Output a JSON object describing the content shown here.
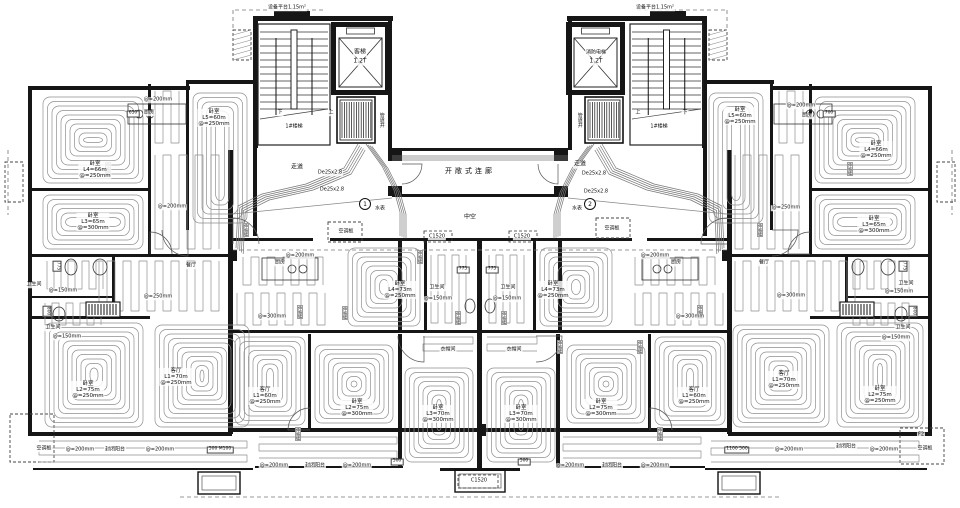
{
  "cores": {
    "left": {
      "platform_area": "设备平台1.15m²",
      "stair": "1#楼梯",
      "up": "上",
      "down": "下",
      "elevator": "客梯",
      "elevator_capacity": "1.2T",
      "shaft": "管道井",
      "corridor": "走道",
      "pipe_spec_1": "De25x2.8",
      "pipe_spec_2": "De25x2.8",
      "water_meter": "水表",
      "meter_no": "1",
      "ac_panel": "空调板"
    },
    "right": {
      "platform_area": "设备平台1.15m²",
      "stair": "1#楼梯",
      "up": "上",
      "down": "下",
      "elevator": "消防电梯",
      "elevator_capacity": "1.2T",
      "shaft": "管道井",
      "corridor": "走道",
      "pipe_spec_1": "De25x2.8",
      "pipe_spec_2": "De25x2.8",
      "water_meter": "水表",
      "meter_no": "2",
      "ac_panel": "空调板"
    }
  },
  "bridge": {
    "connector": "开敞式连廊",
    "void_space": "中空",
    "window_tag": "C1520"
  },
  "rooms": [
    {
      "name": "卧室",
      "circuit": "L4=66m",
      "spacing": "@=250mm"
    },
    {
      "name": "卧室",
      "circuit": "L3=65m",
      "spacing": "@=300mm"
    },
    {
      "name": "卧室",
      "circuit": "L5=60m",
      "spacing": "@=250mm"
    },
    {
      "name": "卧室",
      "circuit": "L2=75m",
      "spacing": "@=250mm"
    },
    {
      "name": "客厅",
      "circuit": "L1=70m",
      "spacing": "@=250mm"
    },
    {
      "name": "客厅",
      "circuit": "L1=60m",
      "spacing": "@=250mm"
    },
    {
      "name": "卧室",
      "circuit": "L4=73m",
      "spacing": "@=250mm"
    },
    {
      "name": "卧室",
      "circuit": "L2=75m",
      "spacing": "@=300mm"
    },
    {
      "name": "卧室",
      "circuit": "L3=70m",
      "spacing": "@=300mm"
    },
    {
      "name": "卧室",
      "circuit": "L4=73m",
      "spacing": "@=250mm"
    },
    {
      "name": "卧室",
      "circuit": "L2=75m",
      "spacing": "@=300mm"
    },
    {
      "name": "卧室",
      "circuit": "L3=70m",
      "spacing": "@=300mm"
    },
    {
      "name": "客厅",
      "circuit": "L1=60m",
      "spacing": "@=250mm"
    },
    {
      "name": "卧室",
      "circuit": "L5=60m",
      "spacing": "@=250mm"
    },
    {
      "name": "卧室",
      "circuit": "L4=66m",
      "spacing": "@=250mm"
    },
    {
      "name": "卧室",
      "circuit": "L3=65m",
      "spacing": "@=300mm"
    },
    {
      "name": "客厅",
      "circuit": "L1=70m",
      "spacing": "@=250mm"
    },
    {
      "name": "卧室",
      "circuit": "L2=75m",
      "spacing": "@=250mm"
    }
  ],
  "zones": [
    {
      "name": "厨房",
      "spacing": "@=200mm",
      "dim": "650"
    },
    {
      "spacing": "@=200mm"
    },
    {
      "name": "餐厅",
      "spacing": "@=250mm"
    },
    {
      "name": "厨房",
      "spacing": "@=200mm"
    },
    {
      "spacing": "@=300mm"
    },
    {
      "name": "厨房",
      "spacing": "@=200mm"
    },
    {
      "spacing": "@=300mm"
    },
    {
      "spacing": "@=250mm"
    },
    {
      "name": "餐厅",
      "spacing": "@=300mm"
    },
    {
      "name": "厨房",
      "spacing": "@=200mm",
      "dim": "700"
    }
  ],
  "baths": [
    {
      "name": "卫生间",
      "spacing": "@=150mm",
      "dim": "775"
    },
    {
      "name": "卫生间",
      "spacing": "@=150mm",
      "dim": "800"
    },
    {
      "name": "卫生间",
      "spacing": "@=150mm",
      "dim": "775"
    },
    {
      "name": "卫生间",
      "spacing": "@=150mm",
      "dim": "775"
    },
    {
      "name": "卫生间",
      "spacing": "@=150mm",
      "dim": "775"
    },
    {
      "name": "卫生间",
      "spacing": "@=150mm",
      "dim": "800"
    }
  ],
  "closets": [
    {
      "name": "衣帽间"
    },
    {
      "name": "衣帽间"
    }
  ],
  "balconies": [
    {
      "spacing_left": "@=200mm",
      "name": "封闭阳台",
      "spacing_right": "@=200mm",
      "dim": "500 M100",
      "ac_panel": "空调板"
    },
    {
      "spacing_left": "@=200mm",
      "name": "封闭阳台",
      "spacing_right": "@=200mm",
      "dim": "500"
    },
    {
      "spacing_left": "@=200mm",
      "name": "封闭阳台",
      "spacing_right": "@=200mm",
      "dim": "500"
    },
    {
      "dim": "1100 500",
      "spacing_left": "@=200mm",
      "name": "封闭阳台",
      "spacing_right": "@=200mm",
      "ac_panel": "空调板",
      "panel_code": "F2"
    }
  ],
  "tags": {
    "expansion_joint": "伸缩缝"
  }
}
